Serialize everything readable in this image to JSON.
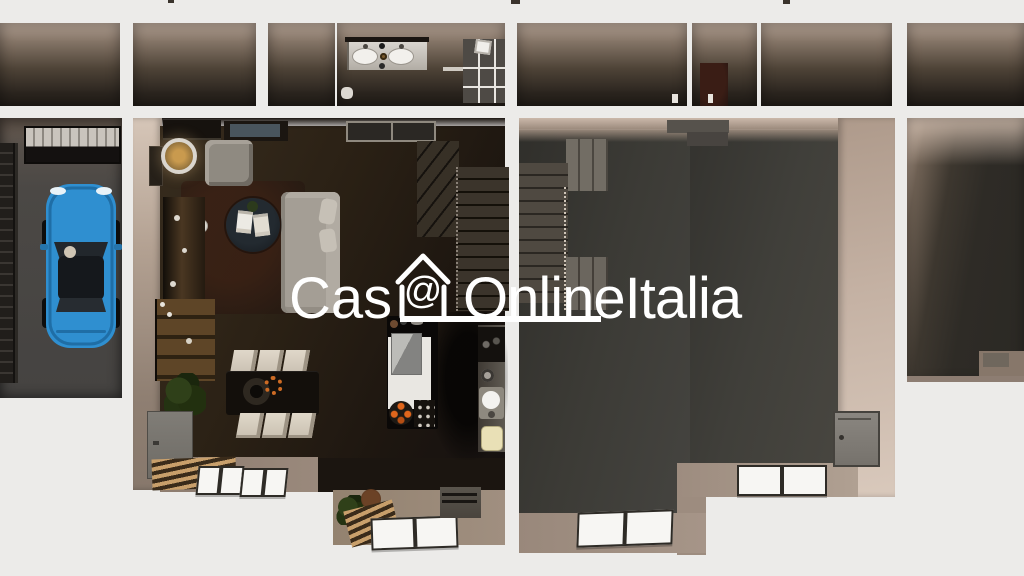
{
  "watermark": {
    "prefix": "Cas",
    "at_symbol": "@",
    "suffix": "OnlineItalia",
    "full_text": "Cas@OnlineItalia",
    "color": "#ffffff"
  },
  "scene": {
    "type": "3d-floor-plan-top-down-render",
    "units": [
      "upper-floor-room-strip",
      "garage",
      "left-unit-ground-floor",
      "right-unit-ground-floor",
      "third-unit-partial"
    ],
    "rooms": [
      "bathroom",
      "garage",
      "living-room",
      "dining-area",
      "kitchen",
      "staircase-left",
      "empty-room-right",
      "staircase-right"
    ],
    "objects": [
      "blue-car",
      "garage-door",
      "storage-rack",
      "floor-lamp",
      "armchair",
      "sofa",
      "throw-pillows",
      "coffee-table",
      "magazines",
      "rug",
      "sideboard",
      "bookshelf",
      "potted-plants",
      "gray-cabinet",
      "dining-table",
      "dining-chairs",
      "fruit-bowl",
      "kitchen-island",
      "range-hood-cube",
      "gas-stove",
      "grill-plate",
      "wall-counter",
      "kitchen-sink",
      "cutting-board",
      "winder-staircase",
      "straight-staircase",
      "double-sink-vanity",
      "shower",
      "towel-rail",
      "windows",
      "wood-plank-benches",
      "entry-threshold",
      "wall-door-panel"
    ]
  },
  "palette": {
    "bg": "#ecebe9",
    "outer_wall": "#f4f2ef",
    "wall_beige": "#c9b6a8",
    "wall_beige_deep": "#8f7f72",
    "floor_brown": "#2b2115",
    "floor_brown_deep": "#171210",
    "floor_gray": "#3c3b36",
    "taupe": "#9a897c",
    "garage_floor": "#4a4845",
    "car_blue": "#2f8fd0",
    "car_glass": "#1c2126",
    "sofa_gray": "#a49e95",
    "chair_beige": "#dcd4c6",
    "wood_dark": "#4a3722",
    "plank_wood": "#c89f6b",
    "stair_gray": "#726d64",
    "flame_orange": "#e0661c",
    "window_white": "#f7f6f3",
    "window_frame": "#2e2b26",
    "watermark": "#ffffff"
  }
}
